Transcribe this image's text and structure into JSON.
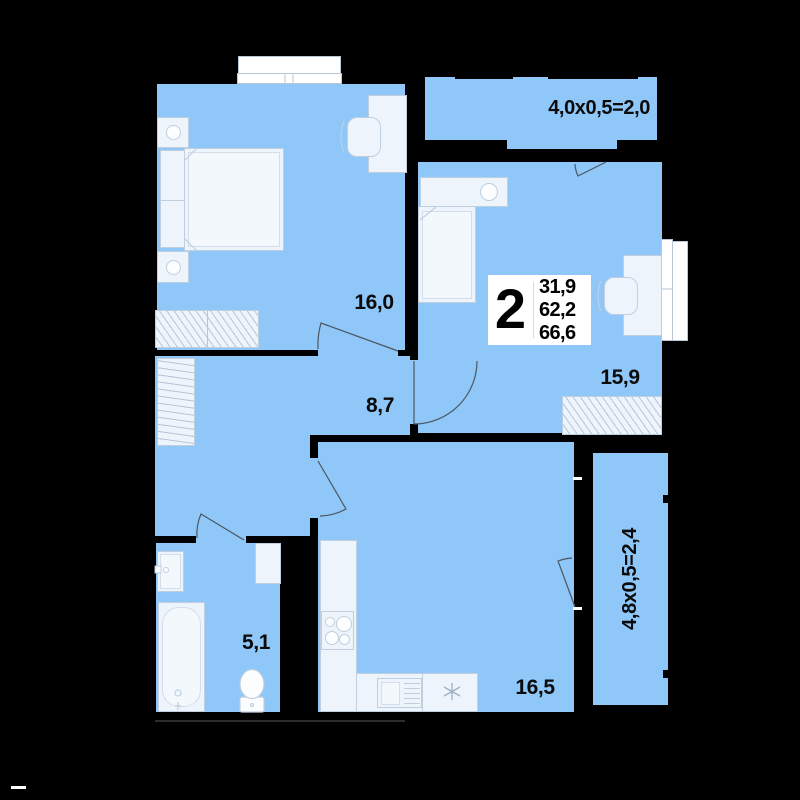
{
  "floor_plan": {
    "unit_info": {
      "rooms_count": "2",
      "area_living": "31,9",
      "area_main": "62,2",
      "area_total": "66,6"
    },
    "room_labels": {
      "bedroom": "16,0",
      "hallway": "8,7",
      "bedroom2": "15,9",
      "kitchen_living": "16,5",
      "bathroom": "5,1"
    },
    "balcony_labels": {
      "top": "4,0x0,5=2,0",
      "right": "4,8x0,5=2,4"
    },
    "colors": {
      "background": "#000000",
      "floor": "#8fc7f8",
      "furniture": "#edf4fb",
      "line_work": "#4a5763"
    }
  }
}
